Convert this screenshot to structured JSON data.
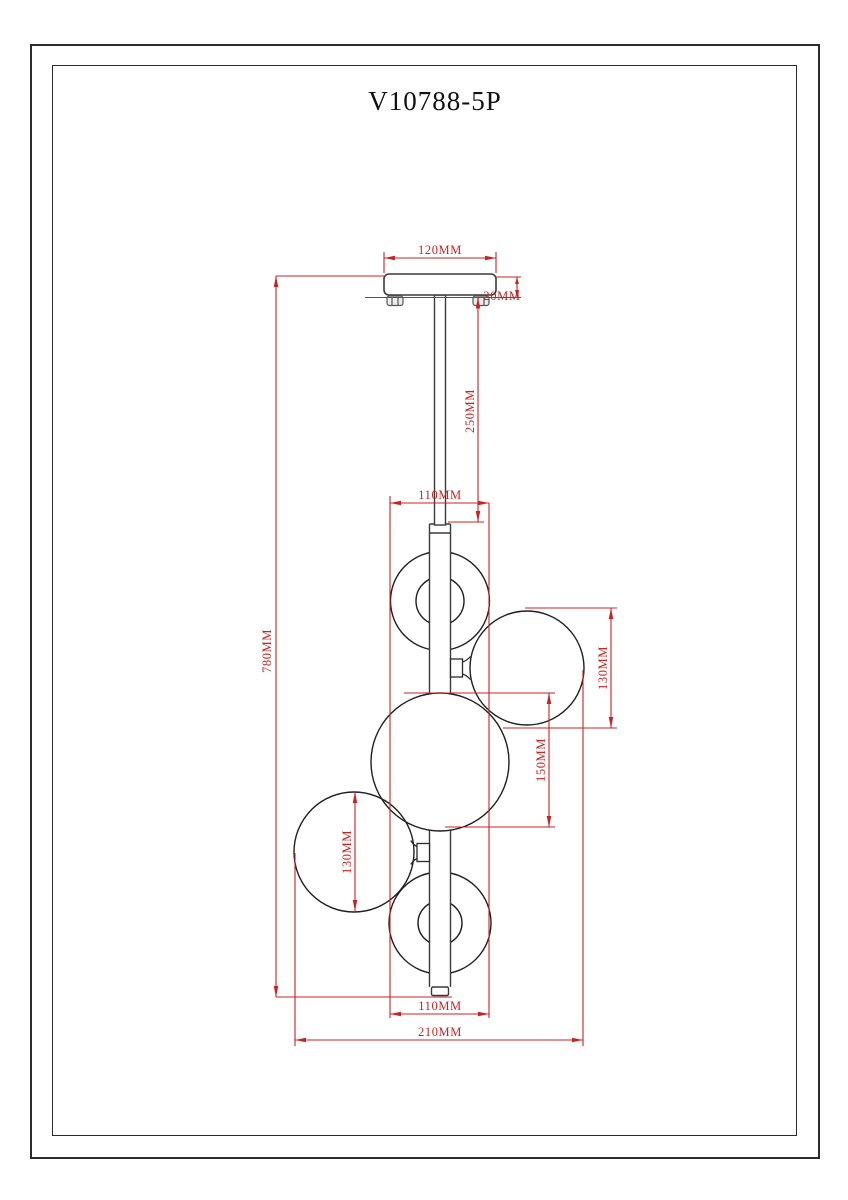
{
  "page": {
    "title": "V10788-5P",
    "background": "#ffffff"
  },
  "drawing": {
    "type": "pendant-lamp-dimension-diagram",
    "colors": {
      "dimension_lines": "#c62424",
      "outlines": "#2b2b2b"
    },
    "labels": {
      "canopy_width": "120MM",
      "canopy_thickness": "20MM",
      "stem_length": "250MM",
      "top_globe_width": "110MM",
      "upper_right_globe_diameter": "130MM",
      "center_globe_diameter": "150MM",
      "lower_left_globe_diameter": "130MM",
      "bottom_globe_width": "110MM",
      "overall_width": "210MM",
      "overall_drop": "780MM"
    }
  }
}
